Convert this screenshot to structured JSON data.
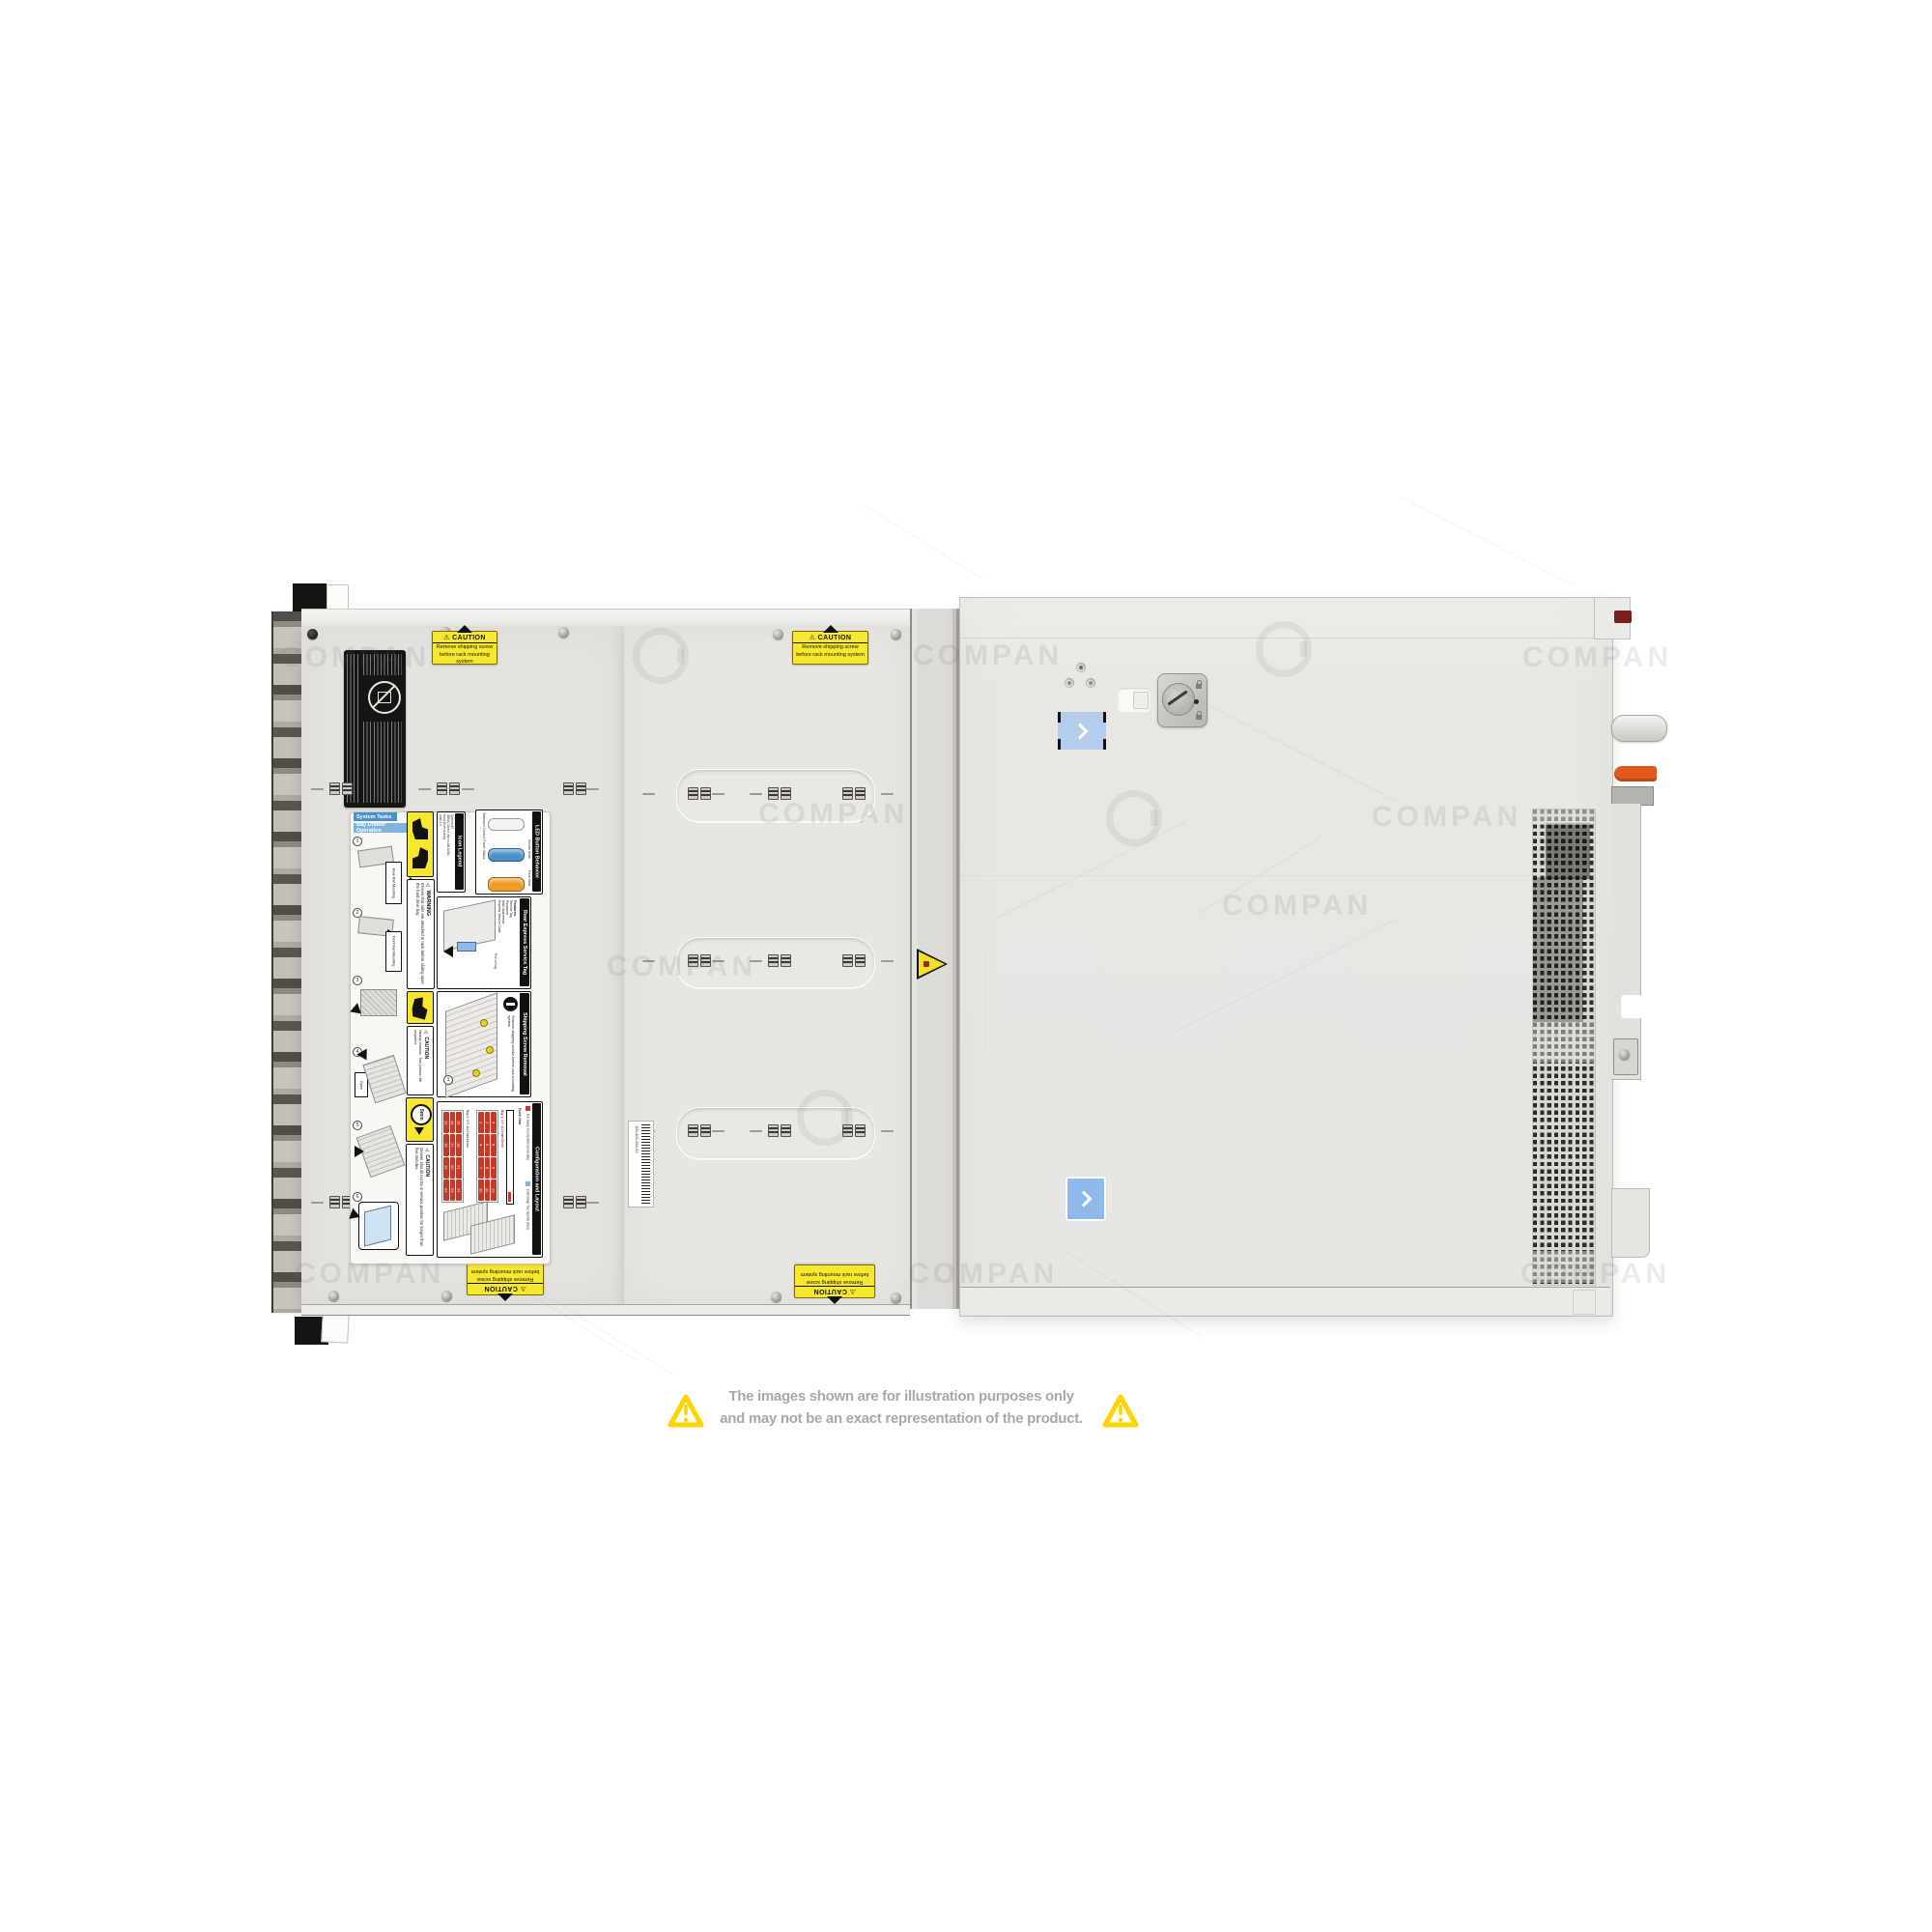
{
  "watermark": {
    "text": "COMPAN"
  },
  "disclaimer": {
    "line1": "The images shown are for illustration purposes only",
    "line2": "and may not be an exact representation of the product."
  },
  "stickers": {
    "caution_title": "⚠ CAUTION",
    "caution_line1": "Remove shipping screw",
    "caution_line2": "before rack mounting system"
  },
  "service_label": {
    "tab1": "System Tasks",
    "tab2": "Bay Drawer Operation",
    "steps": [
      "Rear Rail Mounting",
      "Front Rail Mounting",
      "Open"
    ],
    "step_numbers": [
      "1",
      "2",
      "3",
      "4",
      "5",
      "6"
    ],
    "warning_title": "⚠ WARNING",
    "warning_text": "Ensure that rails are attached to rack before sliding open the hard drive bay.",
    "icon_legend_title": "Icon Legend",
    "icon_legend_items": [
      "System ID",
      "iDRAC Direct (Micro-AB USB)",
      "Hard Drive Activity",
      "USB 2.0"
    ],
    "led_title": "LED Button Behavior",
    "led_subtitle": "Standard Control Panel Status",
    "led_normal": "Normal State",
    "led_fault": "Fault State",
    "rear_tag_title": "Rear Express Service Tag",
    "rear_tag_features_label": "Features:",
    "rear_tag_features": [
      "Service Tag",
      "Password",
      "MAC Addresses",
      "Express Service Code"
    ],
    "rear_tag_note": "Pull out tag",
    "shipping_title": "Shipping Screw Removal",
    "shipping_text": "Remove shipping screws before rack mounting system.",
    "caution_lift_title": "⚠ CAUTION",
    "caution_lift_text": "Heavy chassis. Two person lift required.",
    "timer_label": "5min",
    "caution_drawer_title": "⚠ CAUTION",
    "caution_drawer_text": "Drawer should not be in service position for longer than five minutes.",
    "config_title": "Configuration and Layout",
    "config_front_view": "Front View",
    "config_bay1": "Bay 1: 3.5\" x12 Hard Drives",
    "config_bay2": "Bay 2: 3.5\" x12 Hard Drives",
    "config_legend_hot": "Hot Swap Touchpoints (terracotta)",
    "config_legend_cold": "Cold Swap Touchpoints (blue)",
    "bay1_drives": [
      "1",
      "2",
      "3",
      "4",
      "5",
      "6",
      "7",
      "8",
      "9",
      "10",
      "11",
      "12"
    ],
    "bay2_drives": [
      "13",
      "14",
      "15",
      "16",
      "17",
      "18",
      "19",
      "20",
      "21",
      "22",
      "23",
      "24"
    ]
  },
  "barcode_label": {
    "number": "100-400-294-03"
  },
  "colors": {
    "caution_yellow": "#f7e72f",
    "warning_outline_yellow": "#ffd400",
    "normal_state_blue": "#4a90cc",
    "fault_state_amber": "#f09a28",
    "hot_swap_red": "#c23b2a",
    "cold_swap_blue": "#7fb3de",
    "touchpoint_sticker_blue": "#8fb9ea",
    "rear_handle_orange": "#e05a1e",
    "disclaimer_gray": "#a8a8a8"
  }
}
